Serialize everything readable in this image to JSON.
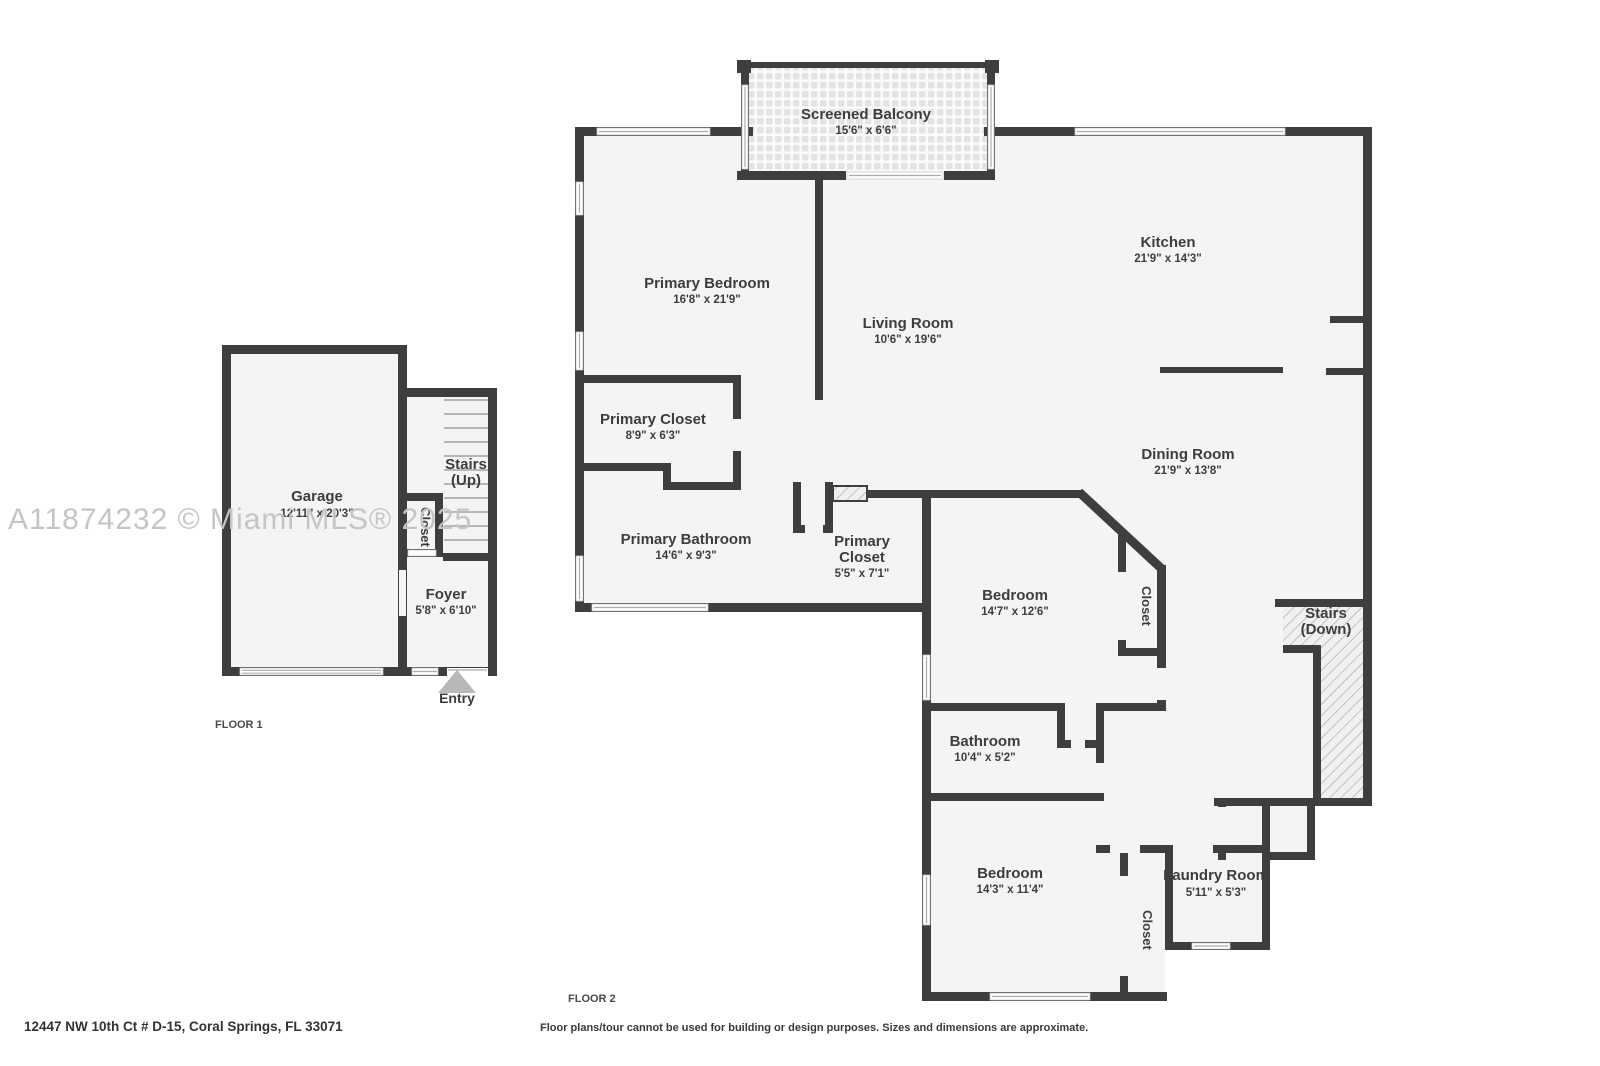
{
  "watermark": "A11874232 © Miami MLS® 2025",
  "footer": {
    "address": "12447 NW 10th Ct # D-15, Coral Springs, FL 33071",
    "disclaimer": "Floor plans/tour cannot be used for building or design purposes. Sizes and dimensions are approximate."
  },
  "floor1": {
    "label": "FLOOR 1",
    "entry_label": "Entry",
    "rooms": {
      "garage": {
        "name": "Garage",
        "dims": "12'11\" x 20'3\""
      },
      "stairs": {
        "name": "Stairs",
        "name2": "(Up)"
      },
      "closet": {
        "name": "Closet"
      },
      "foyer": {
        "name": "Foyer",
        "dims": "5'8\" x 6'10\""
      }
    }
  },
  "floor2": {
    "label": "FLOOR 2",
    "rooms": {
      "balcony": {
        "name": "Screened Balcony",
        "dims": "15'6\" x 6'6\""
      },
      "primary_bedroom": {
        "name": "Primary Bedroom",
        "dims": "16'8\" x 21'9\""
      },
      "living": {
        "name": "Living Room",
        "dims": "10'6\" x 19'6\""
      },
      "kitchen": {
        "name": "Kitchen",
        "dims": "21'9\" x 14'3\""
      },
      "dining": {
        "name": "Dining Room",
        "dims": "21'9\" x 13'8\""
      },
      "primary_closet1": {
        "name": "Primary Closet",
        "dims": "8'9\" x 6'3\""
      },
      "primary_bathroom": {
        "name": "Primary Bathroom",
        "dims": "14'6\" x 9'3\""
      },
      "primary_closet2": {
        "line1": "Primary",
        "line2": "Closet",
        "dims": "5'5\" x 7'1\""
      },
      "bedroom1": {
        "name": "Bedroom",
        "dims": "14'7\" x 12'6\""
      },
      "bedroom1_closet": {
        "name": "Closet"
      },
      "stairs_down": {
        "name": "Stairs",
        "name2": "(Down)"
      },
      "bathroom": {
        "name": "Bathroom",
        "dims": "10'4\" x 5'2\""
      },
      "bedroom2": {
        "name": "Bedroom",
        "dims": "14'3\" x 11'4\""
      },
      "bedroom2_closet": {
        "name": "Closet"
      },
      "laundry": {
        "name": "Laundry Room",
        "dims": "5'11\" x 5'3\""
      }
    }
  },
  "colors": {
    "wall": "#3e3e3e",
    "room_fill": "#f4f4f4",
    "watermark": "#c5c5c5"
  }
}
